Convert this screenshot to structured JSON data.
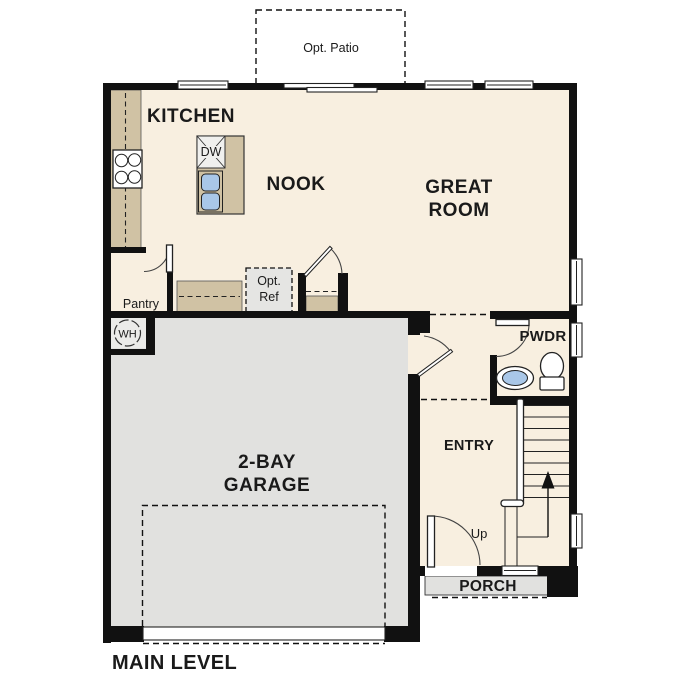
{
  "colors": {
    "floor": "#f8efe0",
    "counter": "#d0c2a4",
    "garage": "#e1e1df",
    "patio": "#e1e1df",
    "porch": "#e1e1df",
    "ref_box": "#e5e5e3",
    "wh_closet": "#ebebe9",
    "fixture_blue": "#a9c7e8",
    "wall": "#111111"
  },
  "labels": {
    "opt_patio": "Opt. Patio",
    "kitchen": "KITCHEN",
    "nook": "NOOK",
    "great_room": [
      "GREAT",
      "ROOM"
    ],
    "dw": "DW",
    "pantry": "Pantry",
    "opt_ref": [
      "Opt.",
      "Ref"
    ],
    "wh": "WH",
    "garage": [
      "2-BAY",
      "GARAGE"
    ],
    "pwdr": "PWDR",
    "entry": "ENTRY",
    "up": "Up",
    "porch": "PORCH",
    "main_level": "MAIN LEVEL"
  }
}
